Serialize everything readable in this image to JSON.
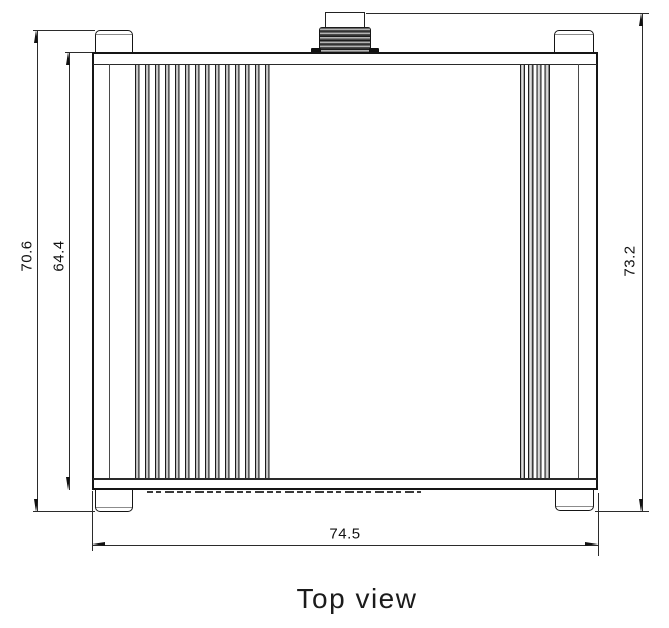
{
  "drawing": {
    "caption": "Top view",
    "dimensions": {
      "overall_height": "70.6",
      "body_height": "64.4",
      "height_with_connector": "73.2",
      "overall_width": "74.5"
    },
    "colors": {
      "line": "#151515",
      "background": "#ffffff"
    },
    "parts": {
      "connector": "threaded-antenna-connector",
      "fins": "heatsink-fins",
      "feet": "corner-mounting-feet"
    }
  }
}
